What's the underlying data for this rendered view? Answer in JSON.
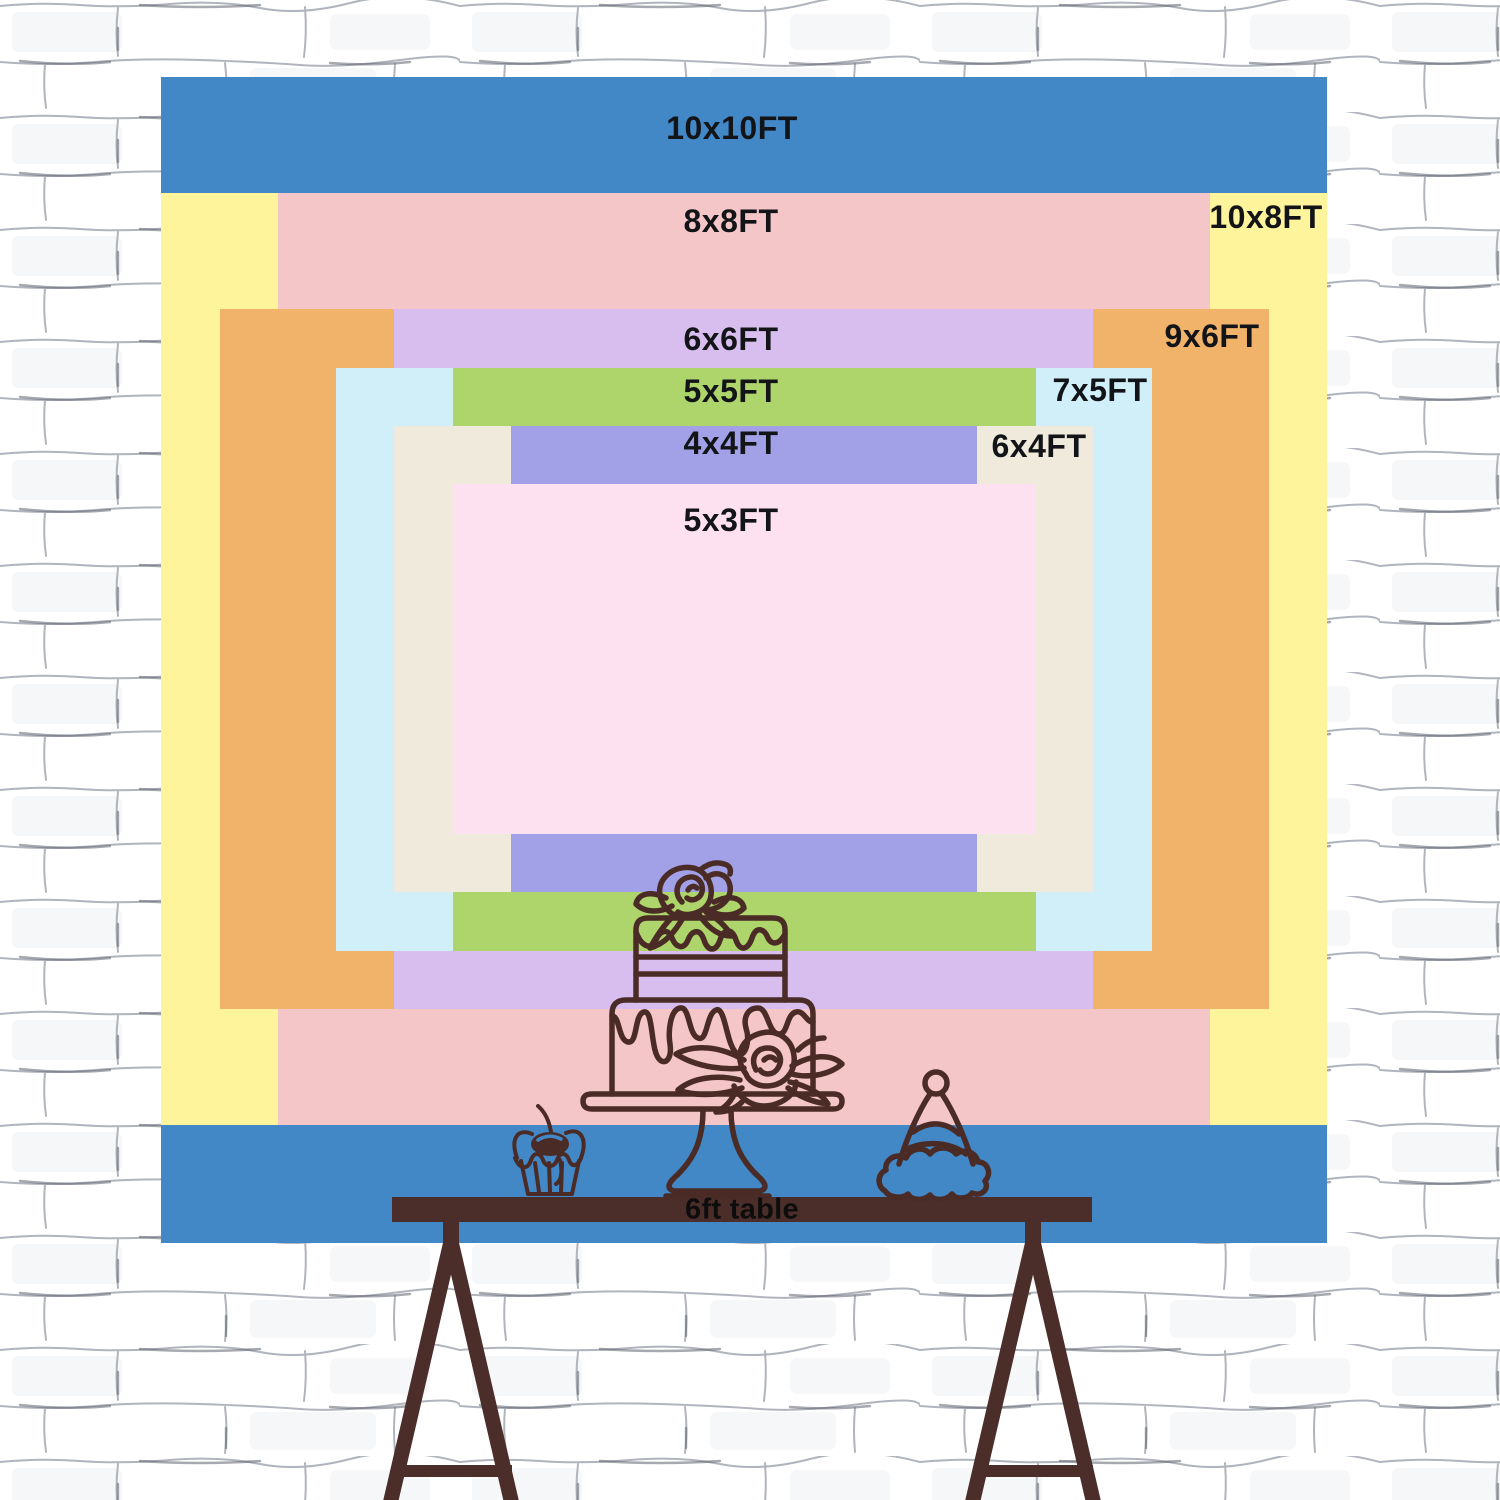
{
  "diagram": {
    "type": "backdrop-size-comparison",
    "sizes": [
      {
        "id": "10x10",
        "label": "10x10FT",
        "width_ft": 10,
        "height_ft": 10,
        "color": "#4287C6"
      },
      {
        "id": "10x8",
        "label": "10x8FT",
        "width_ft": 10,
        "height_ft": 8,
        "color": "#FDF49B"
      },
      {
        "id": "8x8",
        "label": "8x8FT",
        "width_ft": 8,
        "height_ft": 8,
        "color": "#F5C6C8"
      },
      {
        "id": "9x6",
        "label": "9x6FT",
        "width_ft": 9,
        "height_ft": 6,
        "color": "#F0B369"
      },
      {
        "id": "6x6",
        "label": "6x6FT",
        "width_ft": 6,
        "height_ft": 6,
        "color": "#D8BEEE"
      },
      {
        "id": "7x5",
        "label": "7x5FT",
        "width_ft": 7,
        "height_ft": 5,
        "color": "#D1EFF9"
      },
      {
        "id": "5x5",
        "label": "5x5FT",
        "width_ft": 5,
        "height_ft": 5,
        "color": "#ADD56B"
      },
      {
        "id": "6x4",
        "label": "6x4FT",
        "width_ft": 6,
        "height_ft": 4,
        "color": "#EFEADB"
      },
      {
        "id": "4x4",
        "label": "4x4FT",
        "width_ft": 4,
        "height_ft": 4,
        "color": "#A2A1E8"
      },
      {
        "id": "5x3",
        "label": "5x3FT",
        "width_ft": 5,
        "height_ft": 3,
        "color": "#FDE1F0"
      }
    ],
    "table": {
      "label": "6ft table",
      "color": "#4B2D2A"
    },
    "line_color": "#4A2B26"
  }
}
